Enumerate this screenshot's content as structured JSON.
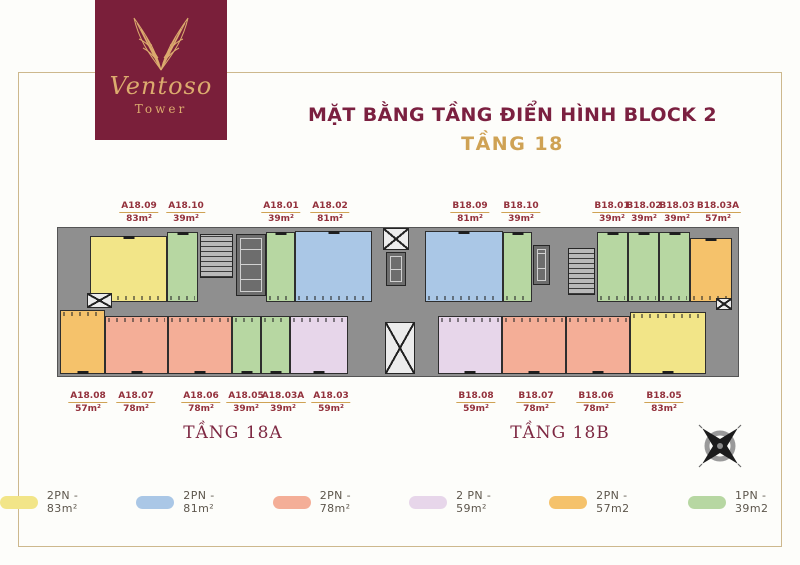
{
  "logo": {
    "brand": "Ventoso",
    "sub": "Tower"
  },
  "title": {
    "line1": "MẶT BẰNG TẦNG ĐIỂN HÌNH BLOCK 2",
    "line2": "TẦNG 18"
  },
  "sections": {
    "left": "TẦNG 18A",
    "right": "TẦNG 18B"
  },
  "colors": {
    "maroon": "#7a1f3a",
    "gold": "#cfa254",
    "frame_gold": "#cdb88d",
    "label_text": "#93313c",
    "slab_gray": "#8f8f8f",
    "wall": "#2e2e2e",
    "types": {
      "yellow": "#f2e588",
      "blue": "#aac7e6",
      "salmon": "#f4ae97",
      "purple": "#e7d6ea",
      "orange": "#f5c26b",
      "green": "#b7d7a2"
    }
  },
  "floorplan": {
    "top_labels": [
      {
        "code": "A18.09",
        "area": "83m²",
        "x": 139
      },
      {
        "code": "A18.10",
        "area": "39m²",
        "x": 186
      },
      {
        "code": "A18.01",
        "area": "39m²",
        "x": 281
      },
      {
        "code": "A18.02",
        "area": "81m²",
        "x": 330
      },
      {
        "code": "B18.09",
        "area": "81m²",
        "x": 470
      },
      {
        "code": "B18.10",
        "area": "39m²",
        "x": 521
      },
      {
        "code": "B18.01",
        "area": "39m²",
        "x": 612
      },
      {
        "code": "B18.02",
        "area": "39m²",
        "x": 644
      },
      {
        "code": "B18.03",
        "area": "39m²",
        "x": 677
      },
      {
        "code": "B18.03A",
        "area": "57m²",
        "x": 718
      }
    ],
    "bottom_labels": [
      {
        "code": "A18.08",
        "area": "57m²",
        "x": 88
      },
      {
        "code": "A18.07",
        "area": "78m²",
        "x": 136
      },
      {
        "code": "A18.06",
        "area": "78m²",
        "x": 201
      },
      {
        "code": "A18.05",
        "area": "39m²",
        "x": 246
      },
      {
        "code": "A18.03A",
        "area": "39m²",
        "x": 283
      },
      {
        "code": "A18.03",
        "area": "59m²",
        "x": 331
      },
      {
        "code": "B18.08",
        "area": "59m²",
        "x": 476
      },
      {
        "code": "B18.07",
        "area": "78m²",
        "x": 536
      },
      {
        "code": "B18.06",
        "area": "78m²",
        "x": 596
      },
      {
        "code": "B18.05",
        "area": "83m²",
        "x": 664
      }
    ],
    "units": [
      {
        "code": "A18.09",
        "type": "yellow",
        "row": "top",
        "x": 32,
        "y": 10,
        "w": 77,
        "h": 66
      },
      {
        "code": "A18.10",
        "type": "green",
        "row": "top",
        "x": 109,
        "y": 6,
        "w": 31,
        "h": 70
      },
      {
        "code": "A18.01",
        "type": "green",
        "row": "top",
        "x": 208,
        "y": 6,
        "w": 29,
        "h": 70
      },
      {
        "code": "A18.02",
        "type": "blue",
        "row": "top",
        "x": 237,
        "y": 5,
        "w": 77,
        "h": 71
      },
      {
        "code": "B18.09",
        "type": "blue",
        "row": "top",
        "x": 367,
        "y": 5,
        "w": 78,
        "h": 71
      },
      {
        "code": "B18.10",
        "type": "green",
        "row": "top",
        "x": 445,
        "y": 6,
        "w": 29,
        "h": 70
      },
      {
        "code": "B18.01",
        "type": "green",
        "row": "top",
        "x": 539,
        "y": 6,
        "w": 31,
        "h": 70
      },
      {
        "code": "B18.02",
        "type": "green",
        "row": "top",
        "x": 570,
        "y": 6,
        "w": 31,
        "h": 70
      },
      {
        "code": "B18.03",
        "type": "green",
        "row": "top",
        "x": 601,
        "y": 6,
        "w": 31,
        "h": 70
      },
      {
        "code": "B18.03A",
        "type": "orange",
        "row": "top",
        "x": 632,
        "y": 12,
        "w": 42,
        "h": 64
      },
      {
        "code": "A18.08",
        "type": "orange",
        "row": "bottom",
        "x": 2,
        "y": 84,
        "w": 45,
        "h": 64
      },
      {
        "code": "A18.07",
        "type": "salmon",
        "row": "bottom",
        "x": 47,
        "y": 90,
        "w": 63,
        "h": 58
      },
      {
        "code": "A18.06",
        "type": "salmon",
        "row": "bottom",
        "x": 110,
        "y": 90,
        "w": 64,
        "h": 58
      },
      {
        "code": "A18.05",
        "type": "green",
        "row": "bottom",
        "x": 174,
        "y": 90,
        "w": 29,
        "h": 58
      },
      {
        "code": "A18.03A",
        "type": "green",
        "row": "bottom",
        "x": 203,
        "y": 90,
        "w": 29,
        "h": 58
      },
      {
        "code": "A18.03",
        "type": "purple",
        "row": "bottom",
        "x": 232,
        "y": 90,
        "w": 58,
        "h": 58
      },
      {
        "code": "B18.08",
        "type": "purple",
        "row": "bottom",
        "x": 380,
        "y": 90,
        "w": 64,
        "h": 58
      },
      {
        "code": "B18.07",
        "type": "salmon",
        "row": "bottom",
        "x": 444,
        "y": 90,
        "w": 64,
        "h": 58
      },
      {
        "code": "B18.06",
        "type": "salmon",
        "row": "bottom",
        "x": 508,
        "y": 90,
        "w": 64,
        "h": 58
      },
      {
        "code": "B18.05",
        "type": "yellow",
        "row": "bottom",
        "x": 572,
        "y": 86,
        "w": 76,
        "h": 62
      }
    ],
    "features": [
      {
        "kind": "stairs",
        "name": "stairwell-left",
        "x": 142,
        "y": 8,
        "w": 33,
        "h": 44
      },
      {
        "kind": "lift",
        "name": "elevator-bank-left",
        "x": 178,
        "y": 8,
        "w": 30,
        "h": 62
      },
      {
        "kind": "xbox",
        "name": "shaft-left",
        "x": 29,
        "y": 67,
        "w": 25,
        "h": 15
      },
      {
        "kind": "xbox",
        "name": "shaft-mid-top",
        "x": 325,
        "y": 2,
        "w": 26,
        "h": 22
      },
      {
        "kind": "lift",
        "name": "elevator-bank-mid",
        "x": 328,
        "y": 26,
        "w": 20,
        "h": 34
      },
      {
        "kind": "xbox",
        "name": "shaft-mid-bottom",
        "x": 327,
        "y": 96,
        "w": 30,
        "h": 52
      },
      {
        "kind": "lift",
        "name": "elevator-bank-right",
        "x": 475,
        "y": 19,
        "w": 17,
        "h": 40
      },
      {
        "kind": "stairs",
        "name": "stairwell-right",
        "x": 510,
        "y": 22,
        "w": 27,
        "h": 47
      },
      {
        "kind": "xbox",
        "name": "shaft-right",
        "x": 658,
        "y": 72,
        "w": 16,
        "h": 12
      }
    ]
  },
  "legend": [
    {
      "label": "2PN - 83m²",
      "type": "yellow"
    },
    {
      "label": "2PN - 81m²",
      "type": "blue"
    },
    {
      "label": "2PN - 78m²",
      "type": "salmon"
    },
    {
      "label": "2 PN - 59m²",
      "type": "purple"
    },
    {
      "label": "2PN - 57m2",
      "type": "orange"
    },
    {
      "label": "1PN - 39m2",
      "type": "green"
    }
  ]
}
